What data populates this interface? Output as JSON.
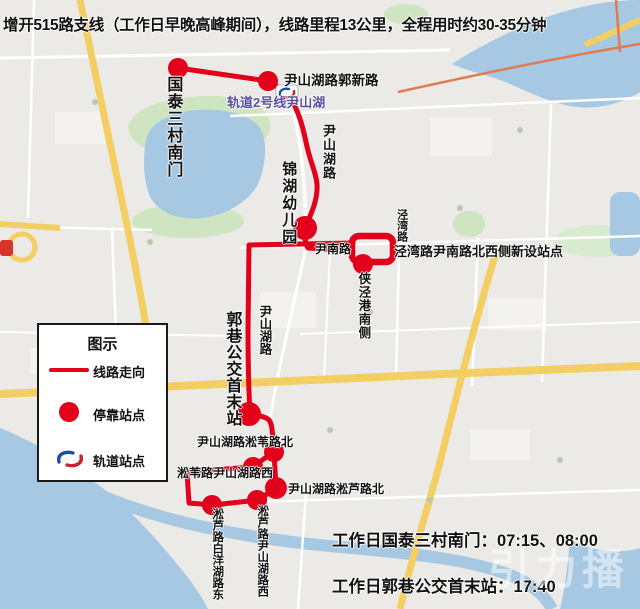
{
  "title": "增开515路支线（工作日早晚高峰期间），线路里程13公里，全程用时约30-35分钟",
  "legend": {
    "title": "图示",
    "line_label": "线路走向",
    "stop_label": "停靠站点",
    "rail_label": "轨道站点"
  },
  "stops": {
    "guotai": "国泰三村南门",
    "guoxin": "尹山湖路郭新路",
    "rail_station": "轨道2号线尹山湖",
    "jinhu": "锦湖幼儿园",
    "jingwan_new": "泾湾路尹南路北西侧新设站点",
    "xiajinggang": "侠泾港南侧",
    "guoxiang": "郭巷公交首末站",
    "songwei_north": "尹山湖路淞苇路北",
    "songwei_west": "淞苇路尹山湖路西",
    "songlu_north": "尹山湖路淞芦路北",
    "songlu_west": "淞芦路尹山湖路西",
    "baiyang_east": "淞芦路白洋湖路东"
  },
  "streets": {
    "yinshanhu_road_upper": "尹山湖路",
    "yinshanhu_road_lower": "尹山湖路",
    "yinnan_road": "尹南路",
    "jingwan_road": "泾湾路"
  },
  "schedule": {
    "line1": "工作日国泰三村南门：07:15、08:00",
    "line2": "工作日郭巷公交首末站：17:40"
  },
  "watermark": "引力播",
  "colors": {
    "route": "#e2001a",
    "rail_text": "#5b4ea5",
    "water": "#a6c8e3",
    "road_yellow": "#f3cf63"
  }
}
